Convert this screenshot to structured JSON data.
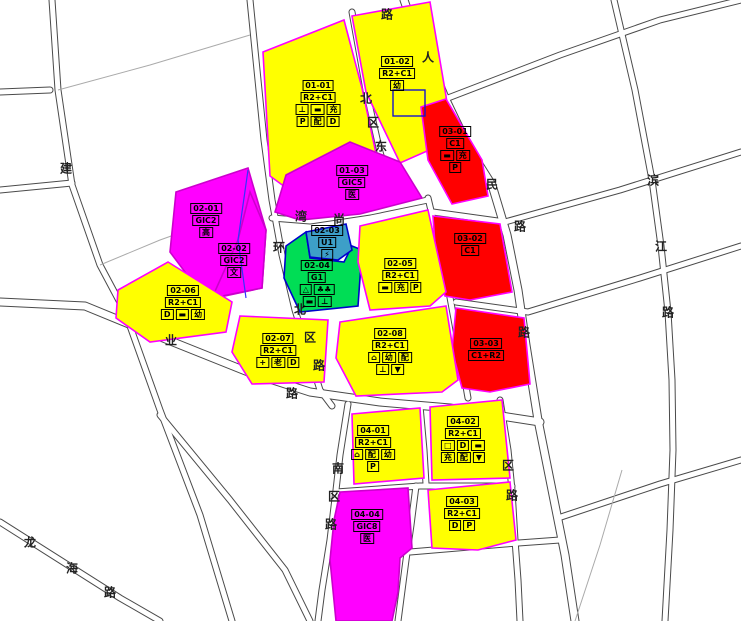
{
  "map_title": "控制性详细规划地块图",
  "colors": {
    "residential_commercial": "#ffff00",
    "public_gic": "#ff00ff",
    "commercial": "#ff0000",
    "green_space": "#00dd55",
    "utility": "#3d9fc8",
    "boundary_pink": "#ff00ff",
    "boundary_blue": "#0000cc",
    "metro_line": "#1414cc",
    "special_line": "#ff6600",
    "road_edge": "#4a4a4a"
  },
  "parcels": [
    {
      "id": "01-01",
      "landuse": "R2+C1",
      "color_key": "residential_commercial",
      "label": {
        "x": 318,
        "y": 104
      },
      "rows": [
        [
          "01-01"
        ],
        [
          "R2+C1"
        ],
        [
          "⊥",
          "▬",
          "充"
        ],
        [
          "P",
          "配",
          "D"
        ]
      ]
    },
    {
      "id": "01-02",
      "landuse": "R2+C1",
      "color_key": "residential_commercial",
      "label": {
        "x": 397,
        "y": 74
      },
      "rows": [
        [
          "01-02"
        ],
        [
          "R2+C1"
        ],
        [
          "幼"
        ]
      ]
    },
    {
      "id": "01-03",
      "landuse": "GIC5",
      "color_key": "public_gic",
      "label": {
        "x": 352,
        "y": 183
      },
      "rows": [
        [
          "01-03"
        ],
        [
          "GIC5"
        ],
        [
          "医"
        ]
      ]
    },
    {
      "id": "03-01",
      "landuse": "C1",
      "color_key": "commercial",
      "label": {
        "x": 455,
        "y": 150
      },
      "rows": [
        [
          "03-01"
        ],
        [
          "C1"
        ],
        [
          "▬",
          "充"
        ],
        [
          "P"
        ]
      ]
    },
    {
      "id": "03-02",
      "landuse": "C1",
      "color_key": "commercial",
      "label": {
        "x": 470,
        "y": 245
      },
      "rows": [
        [
          "03-02"
        ],
        [
          "C1"
        ]
      ]
    },
    {
      "id": "03-03",
      "landuse": "C1+R2",
      "color_key": "commercial",
      "label": {
        "x": 486,
        "y": 350
      },
      "rows": [
        [
          "03-03"
        ],
        [
          "C1+R2"
        ]
      ]
    },
    {
      "id": "02-01",
      "landuse": "GIC2",
      "color_key": "public_gic",
      "label": {
        "x": 206,
        "y": 221
      },
      "rows": [
        [
          "02-01"
        ],
        [
          "GIC2"
        ],
        [
          "高"
        ]
      ]
    },
    {
      "id": "02-02",
      "landuse": "GIC2",
      "color_key": "public_gic",
      "label": {
        "x": 234,
        "y": 261
      },
      "rows": [
        [
          "02-02"
        ],
        [
          "GIC2"
        ],
        [
          "文"
        ]
      ]
    },
    {
      "id": "02-03",
      "landuse": "U1",
      "color_key": "utility",
      "label": {
        "x": 327,
        "y": 243
      },
      "rows": [
        [
          "02-03"
        ],
        [
          "U1"
        ],
        [
          "⚡"
        ]
      ]
    },
    {
      "id": "02-04",
      "landuse": "G1",
      "color_key": "green_space",
      "label": {
        "x": 317,
        "y": 284
      },
      "rows": [
        [
          "02-04"
        ],
        [
          "G1"
        ],
        [
          "△",
          "♣♣"
        ],
        [
          "▬",
          "⊥"
        ]
      ]
    },
    {
      "id": "02-05",
      "landuse": "R2+C1",
      "color_key": "residential_commercial",
      "label": {
        "x": 400,
        "y": 276
      },
      "rows": [
        [
          "02-05"
        ],
        [
          "R2+C1"
        ],
        [
          "▬",
          "充",
          "P"
        ]
      ]
    },
    {
      "id": "02-06",
      "landuse": "R2+C1",
      "color_key": "residential_commercial",
      "label": {
        "x": 183,
        "y": 303
      },
      "rows": [
        [
          "02-06"
        ],
        [
          "R2+C1"
        ],
        [
          "D",
          "▬",
          "幼"
        ]
      ]
    },
    {
      "id": "02-07",
      "landuse": "R2+C1",
      "color_key": "residential_commercial",
      "label": {
        "x": 278,
        "y": 351
      },
      "rows": [
        [
          "02-07"
        ],
        [
          "R2+C1"
        ],
        [
          "+",
          "老",
          "D"
        ]
      ]
    },
    {
      "id": "02-08",
      "landuse": "R2+C1",
      "color_key": "residential_commercial",
      "label": {
        "x": 390,
        "y": 352
      },
      "rows": [
        [
          "02-08"
        ],
        [
          "R2+C1"
        ],
        [
          "⌂",
          "幼",
          "配"
        ],
        [
          "⊥",
          "▼"
        ]
      ]
    },
    {
      "id": "04-01",
      "landuse": "R2+C1",
      "color_key": "residential_commercial",
      "label": {
        "x": 373,
        "y": 449
      },
      "rows": [
        [
          "04-01"
        ],
        [
          "R2+C1"
        ],
        [
          "⌂",
          "配",
          "幼"
        ],
        [
          "P"
        ]
      ]
    },
    {
      "id": "04-02",
      "landuse": "R2+C1",
      "color_key": "residential_commercial",
      "label": {
        "x": 463,
        "y": 440
      },
      "rows": [
        [
          "04-02"
        ],
        [
          "R2+C1"
        ],
        [
          "□",
          "D",
          "▬"
        ],
        [
          "充",
          "配",
          "▼"
        ]
      ]
    },
    {
      "id": "04-03",
      "landuse": "R2+C1",
      "color_key": "residential_commercial",
      "label": {
        "x": 462,
        "y": 514
      },
      "rows": [
        [
          "04-03"
        ],
        [
          "R2+C1"
        ],
        [
          "D",
          "P"
        ]
      ]
    },
    {
      "id": "04-04",
      "landuse": "GIC8",
      "color_key": "public_gic",
      "label": {
        "x": 367,
        "y": 527
      },
      "rows": [
        [
          "04-04"
        ],
        [
          "GIC8"
        ],
        [
          "医"
        ]
      ]
    }
  ],
  "road_labels": [
    {
      "char": "路",
      "x": 387,
      "y": 14
    },
    {
      "char": "人",
      "x": 428,
      "y": 57
    },
    {
      "char": "民",
      "x": 492,
      "y": 184
    },
    {
      "char": "路",
      "x": 520,
      "y": 226
    },
    {
      "char": "路",
      "x": 524,
      "y": 332
    },
    {
      "char": "北",
      "x": 366,
      "y": 98
    },
    {
      "char": "区",
      "x": 373,
      "y": 122
    },
    {
      "char": "东",
      "x": 381,
      "y": 146
    },
    {
      "char": "湾",
      "x": 301,
      "y": 216
    },
    {
      "char": "尚",
      "x": 339,
      "y": 219
    },
    {
      "char": "环",
      "x": 279,
      "y": 247
    },
    {
      "char": "北",
      "x": 300,
      "y": 309
    },
    {
      "char": "区",
      "x": 310,
      "y": 337
    },
    {
      "char": "路",
      "x": 319,
      "y": 365
    },
    {
      "char": "业",
      "x": 171,
      "y": 340
    },
    {
      "char": "路",
      "x": 292,
      "y": 393
    },
    {
      "char": "滨",
      "x": 653,
      "y": 180
    },
    {
      "char": "江",
      "x": 661,
      "y": 246
    },
    {
      "char": "路",
      "x": 668,
      "y": 312
    },
    {
      "char": "建",
      "x": 66,
      "y": 168
    },
    {
      "char": "龙",
      "x": 30,
      "y": 542
    },
    {
      "char": "海",
      "x": 72,
      "y": 568
    },
    {
      "char": "路",
      "x": 110,
      "y": 592
    },
    {
      "char": "南",
      "x": 338,
      "y": 468
    },
    {
      "char": "区",
      "x": 334,
      "y": 496
    },
    {
      "char": "路",
      "x": 331,
      "y": 524
    },
    {
      "char": "区",
      "x": 508,
      "y": 465
    },
    {
      "char": "路",
      "x": 512,
      "y": 495
    }
  ]
}
